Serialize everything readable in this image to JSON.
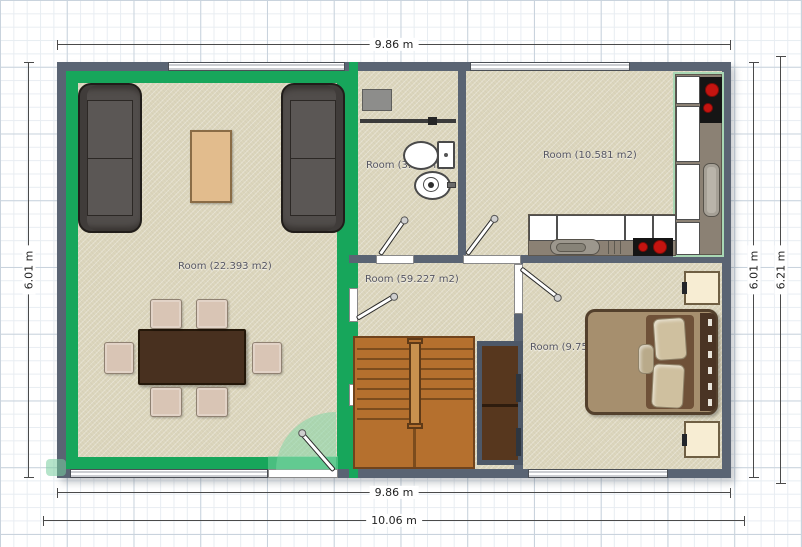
{
  "plan": {
    "dimension_labels": {
      "top": "9.86 m",
      "left": "6.01 m",
      "right_inner": "6.01 m",
      "right_outer": "6.21 m",
      "bottom_inner": "9.86 m",
      "bottom_outer": "10.06 m"
    },
    "rooms": {
      "living_room": {
        "label": "Room (22.393 m2)"
      },
      "bathroom": {
        "label": "Room (3.823 m2)"
      },
      "kitchen": {
        "label": "Room (10.581 m2)"
      },
      "hallway": {
        "label": "Room (59.227 m2)"
      },
      "bedroom": {
        "label": "Room (9.75"
      }
    },
    "colors": {
      "wall": "#5a6473",
      "floor": "#dcd6bd",
      "selection": "#17a65b",
      "selection-light": "rgba(124,214,164,0.5)",
      "stairs": "#b5702e",
      "stairs-line": "#7c4c1d",
      "closet": "#57371e",
      "counter": "#8b8174",
      "cooktop": "#151515",
      "burner": "#c41410",
      "sofa": "#514d4b",
      "table": "#48301f",
      "chair": "#d9c5b5",
      "bed-frame": "#53402c",
      "mattress": "#a68f6e",
      "duvet": "#6f5138",
      "pillow": "#cfc09f",
      "nightstand": "#f7edd3",
      "coffee-table": "#e2bc8d"
    }
  }
}
